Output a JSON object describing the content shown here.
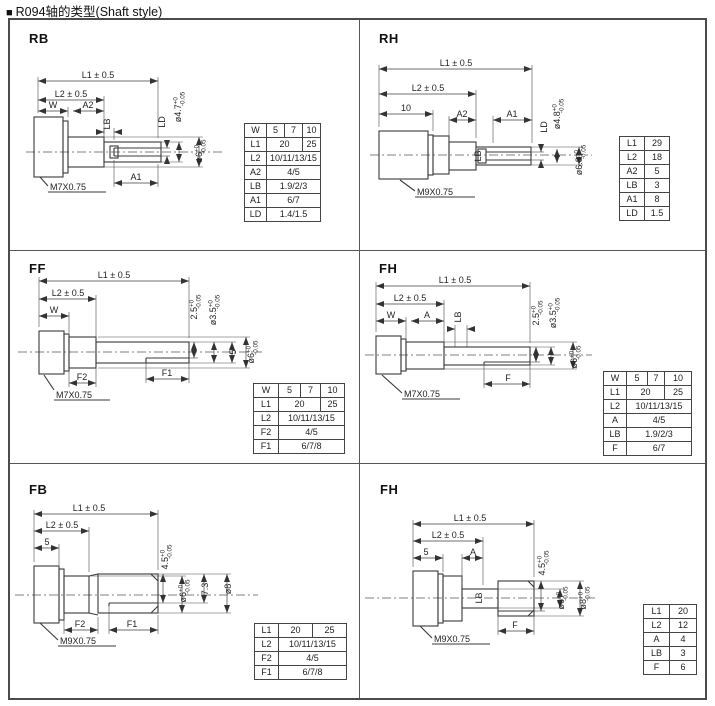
{
  "title": {
    "bullet": "■",
    "text": "R094轴的类型(Shaft style)"
  },
  "panels": {
    "rb": {
      "label": "RB",
      "ann": {
        "l1": "L1 ± 0.5",
        "l2": "L2 ± 0.5",
        "w": "W",
        "a2": "A2",
        "a1": "A1",
        "lb": "LB",
        "ld": "LD",
        "thread": "M7X0.75"
      },
      "dias": {
        "d1": {
          "base": "ø4.7",
          "sup": "+0",
          "sub": "-0.05"
        },
        "d2": {
          "base": "ø6",
          "sup": "+0",
          "sub": "-0.05"
        }
      },
      "table": {
        "col_widths": [
          22,
          18,
          18,
          18
        ],
        "rows": [
          {
            "h": "W",
            "cells": [
              {
                "t": "5",
                "s": 1
              },
              {
                "t": "7",
                "s": 1
              },
              {
                "t": "10",
                "s": 1
              }
            ]
          },
          {
            "h": "L1",
            "cells": [
              {
                "t": "20",
                "s": 2
              },
              {
                "t": "25",
                "s": 1
              }
            ]
          },
          {
            "h": "L2",
            "cells": [
              {
                "t": "10/11/13/15",
                "s": 3
              }
            ]
          },
          {
            "h": "A2",
            "cells": [
              {
                "t": "4/5",
                "s": 3
              }
            ]
          },
          {
            "h": "LB",
            "cells": [
              {
                "t": "1.9/2/3",
                "s": 3
              }
            ]
          },
          {
            "h": "A1",
            "cells": [
              {
                "t": "6/7",
                "s": 3
              }
            ]
          },
          {
            "h": "LD",
            "cells": [
              {
                "t": "1.4/1.5",
                "s": 3
              }
            ]
          }
        ]
      }
    },
    "rh": {
      "label": "RH",
      "ann": {
        "l1": "L1 ± 0.5",
        "l2": "L2 ± 0.5",
        "len10": "10",
        "a2": "A2",
        "a1": "A1",
        "lb": "LB",
        "ld": "LD",
        "thread": "M9X0.75"
      },
      "dias": {
        "d1": {
          "base": "ø4.8",
          "sup": "+0",
          "sub": "-0.05"
        },
        "d2": {
          "base": "ø6.8",
          "sup": "+0",
          "sub": "-0.05"
        }
      },
      "table": {
        "col_widths": [
          25,
          25
        ],
        "rows": [
          {
            "h": "L1",
            "cells": [
              {
                "t": "29",
                "s": 1
              }
            ]
          },
          {
            "h": "L2",
            "cells": [
              {
                "t": "18",
                "s": 1
              }
            ]
          },
          {
            "h": "A2",
            "cells": [
              {
                "t": "5",
                "s": 1
              }
            ]
          },
          {
            "h": "LB",
            "cells": [
              {
                "t": "3",
                "s": 1
              }
            ]
          },
          {
            "h": "A1",
            "cells": [
              {
                "t": "8",
                "s": 1
              }
            ]
          },
          {
            "h": "LD",
            "cells": [
              {
                "t": "1.5",
                "s": 1
              }
            ]
          }
        ]
      }
    },
    "ff": {
      "label": "FF",
      "ann": {
        "l1": "L1 ± 0.5",
        "l2": "L2 ± 0.5",
        "w": "W",
        "f2": "F2",
        "f1": "F1",
        "five": "5",
        "thread": "M7X0.75"
      },
      "dias": {
        "d1": {
          "base": "2.5",
          "sup": "+0",
          "sub": "-0.05"
        },
        "d2": {
          "base": "ø3.5",
          "sup": "+0",
          "sub": "-0.05"
        },
        "d3": {
          "base": "ø6",
          "sup": "+0",
          "sub": "-0.05"
        }
      },
      "table": {
        "col_widths": [
          25,
          22,
          20,
          24
        ],
        "rows": [
          {
            "h": "W",
            "cells": [
              {
                "t": "5",
                "s": 1
              },
              {
                "t": "7",
                "s": 1
              },
              {
                "t": "10",
                "s": 1
              }
            ]
          },
          {
            "h": "L1",
            "cells": [
              {
                "t": "20",
                "s": 2
              },
              {
                "t": "25",
                "s": 1
              }
            ]
          },
          {
            "h": "L2",
            "cells": [
              {
                "t": "10/11/13/15",
                "s": 3
              }
            ]
          },
          {
            "h": "F2",
            "cells": [
              {
                "t": "4/5",
                "s": 3
              }
            ]
          },
          {
            "h": "F1",
            "cells": [
              {
                "t": "6/7/8",
                "s": 3
              }
            ]
          }
        ]
      }
    },
    "fh2": {
      "label": "FH",
      "ann": {
        "l1": "L1 ± 0.5",
        "l2": "L2 ± 0.5",
        "w": "W",
        "a": "A",
        "lb": "LB",
        "f": "F",
        "thread": "M7X0.75"
      },
      "dias": {
        "d1": {
          "base": "2.5",
          "sup": "+0",
          "sub": "-0.05"
        },
        "d2": {
          "base": "ø3.5",
          "sup": "+0",
          "sub": "-0.05"
        },
        "d3": {
          "base": "ø6",
          "sup": "+0",
          "sub": "-0.05"
        }
      },
      "table": {
        "col_widths": [
          23,
          21,
          17,
          27
        ],
        "rows": [
          {
            "h": "W",
            "cells": [
              {
                "t": "5",
                "s": 1
              },
              {
                "t": "7",
                "s": 1
              },
              {
                "t": "10",
                "s": 1
              }
            ]
          },
          {
            "h": "L1",
            "cells": [
              {
                "t": "20",
                "s": 2
              },
              {
                "t": "25",
                "s": 1
              }
            ]
          },
          {
            "h": "L2",
            "cells": [
              {
                "t": "10/11/13/15",
                "s": 3
              }
            ]
          },
          {
            "h": "A",
            "cells": [
              {
                "t": "4/5",
                "s": 3
              }
            ]
          },
          {
            "h": "LB",
            "cells": [
              {
                "t": "1.9/2/3",
                "s": 3
              }
            ]
          },
          {
            "h": "F",
            "cells": [
              {
                "t": "6/7",
                "s": 3
              }
            ]
          }
        ]
      }
    },
    "fb": {
      "label": "FB",
      "ann": {
        "l1": "L1 ± 0.5",
        "l2": "L2 ± 0.5",
        "five": "5",
        "f2": "F2",
        "f1": "F1",
        "seven3": "7.3",
        "dia8": "ø8",
        "thread": "M9X0.75"
      },
      "dias": {
        "d1": {
          "base": "4.5",
          "sup": "+0",
          "sub": "-0.05"
        },
        "d2": {
          "base": "ø6",
          "sup": "+0",
          "sub": "-0.05"
        }
      },
      "table": {
        "col_widths": [
          24,
          34,
          34
        ],
        "rows": [
          {
            "h": "L1",
            "cells": [
              {
                "t": "20",
                "s": 1
              },
              {
                "t": "25",
                "s": 1
              }
            ]
          },
          {
            "h": "L2",
            "cells": [
              {
                "t": "10/11/13/15",
                "s": 2
              }
            ]
          },
          {
            "h": "F2",
            "cells": [
              {
                "t": "4/5",
                "s": 2
              }
            ]
          },
          {
            "h": "F1",
            "cells": [
              {
                "t": "6/7/8",
                "s": 2
              }
            ]
          }
        ]
      }
    },
    "fh3": {
      "label": "FH",
      "ann": {
        "l1": "L1 ± 0.5",
        "l2": "L2 ± 0.5",
        "five": "5",
        "a": "A",
        "lb": "LB",
        "f": "F",
        "thread": "M9X0.75"
      },
      "dias": {
        "d1": {
          "base": "4.5",
          "sup": "+0",
          "sub": "-0.05"
        },
        "d2": {
          "base": "ø6",
          "sup": "+0",
          "sub": "-0.05"
        },
        "d3": {
          "base": "ø8",
          "sup": "+0",
          "sub": "-0.05"
        }
      },
      "table": {
        "col_widths": [
          26,
          27
        ],
        "rows": [
          {
            "h": "L1",
            "cells": [
              {
                "t": "20",
                "s": 1
              }
            ]
          },
          {
            "h": "L2",
            "cells": [
              {
                "t": "12",
                "s": 1
              }
            ]
          },
          {
            "h": "A",
            "cells": [
              {
                "t": "4",
                "s": 1
              }
            ]
          },
          {
            "h": "LB",
            "cells": [
              {
                "t": "3",
                "s": 1
              }
            ]
          },
          {
            "h": "F",
            "cells": [
              {
                "t": "6",
                "s": 1
              }
            ]
          }
        ]
      }
    }
  }
}
